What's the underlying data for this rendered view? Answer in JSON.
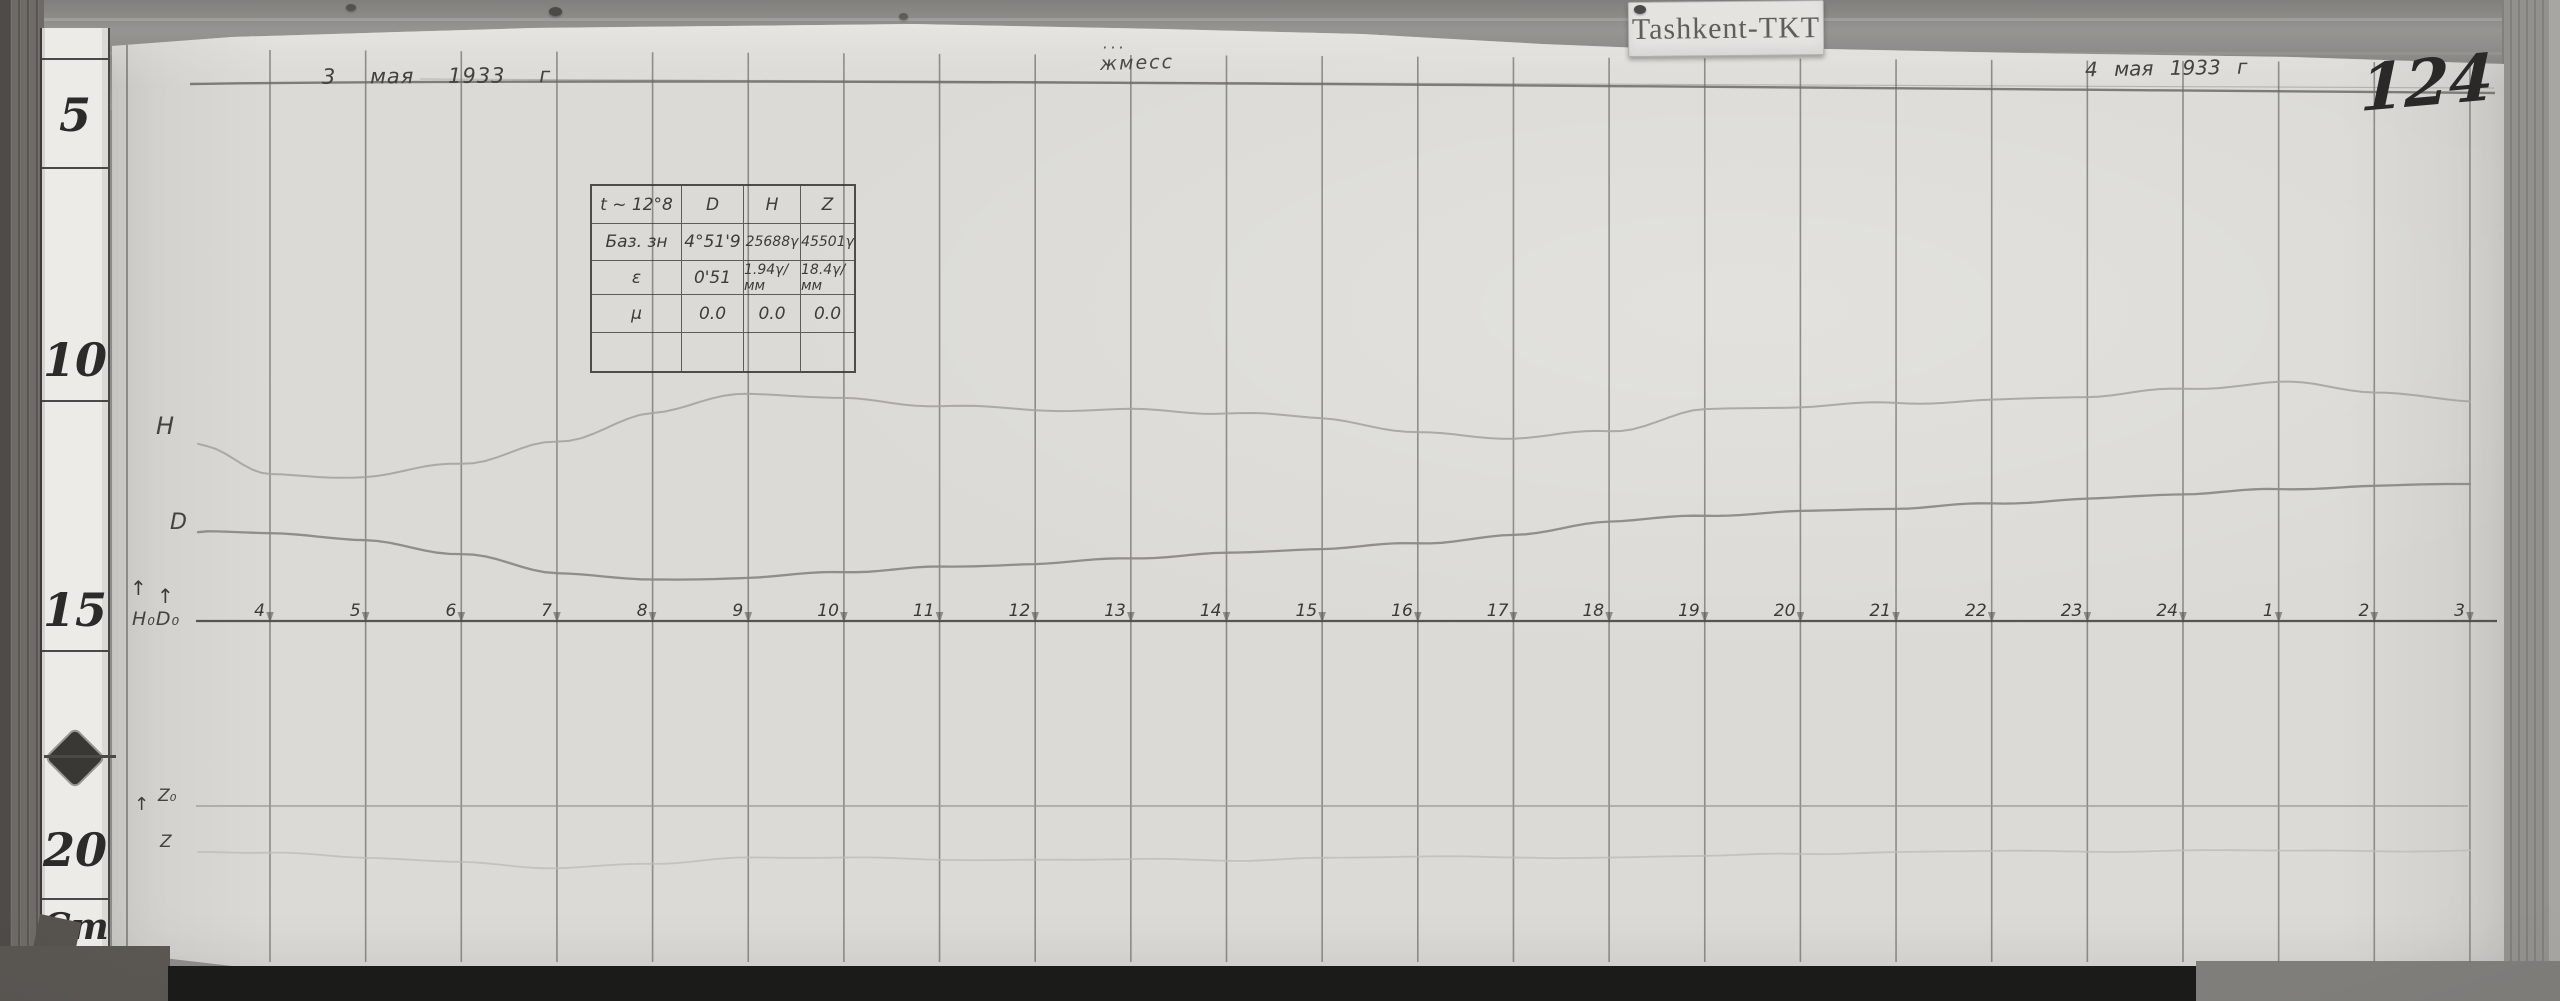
{
  "scene": {
    "station_label": "Tashkent-TKT",
    "page_number": "124",
    "date_left": "3 мая 1933 г",
    "date_right": "4 мая 1933 г",
    "center_annotation": "жмесс",
    "center_annotation_dots": "···",
    "up_arrow": "↑"
  },
  "ruler": {
    "marks": [
      "5",
      "10",
      "15",
      "20"
    ],
    "unit": "Cm"
  },
  "trace_labels": {
    "h": "H",
    "d": "D",
    "baseline": "H₀D₀",
    "z0": "Z₀",
    "z": "Z"
  },
  "table": {
    "header": [
      "t ~ 12°8",
      "D",
      "H",
      "Z"
    ],
    "rows": [
      [
        "Баз. зн",
        "4°51'9",
        "25688γ",
        "45501γ"
      ],
      [
        "ε",
        "0'51",
        "1.94γ/мм",
        "18.4γ/мм"
      ],
      [
        "μ",
        "0.0",
        "0.0",
        "0.0"
      ],
      [
        "",
        "",
        "",
        ""
      ]
    ]
  },
  "chart_data": {
    "type": "line",
    "title": "Magnetogram Tashkent-TKT, 3–4 мая 1933 г",
    "xlabel": "hour (local time)",
    "ylabel": "pen deflection, mm from baseline",
    "categories": [
      "4",
      "5",
      "6",
      "7",
      "8",
      "9",
      "10",
      "11",
      "12",
      "13",
      "14",
      "15",
      "16",
      "17",
      "18",
      "19",
      "20",
      "21",
      "22",
      "23",
      "24",
      "1",
      "2",
      "3"
    ],
    "series": [
      {
        "name": "H",
        "baseline": "H₀D₀",
        "unit": "mm above baseline",
        "lead_in_mm": 37.7,
        "values": [
          31.0,
          30.4,
          33.6,
          38.1,
          44.5,
          48.5,
          47.0,
          45.7,
          45.1,
          45.1,
          44.3,
          43.0,
          39.8,
          39.1,
          40.6,
          44.9,
          45.5,
          46.2,
          47.0,
          48.1,
          49.4,
          50.6,
          48.7,
          46.6
        ]
      },
      {
        "name": "D",
        "baseline": "H₀D₀",
        "unit": "mm above baseline",
        "lead_in_mm": 18.9,
        "values": [
          18.7,
          17.0,
          14.3,
          10.4,
          8.7,
          9.1,
          10.4,
          11.5,
          12.3,
          13.4,
          14.3,
          15.3,
          16.6,
          18.3,
          21.3,
          22.3,
          23.2,
          24.0,
          25.1,
          26.0,
          27.0,
          27.9,
          28.7,
          29.4
        ]
      },
      {
        "name": "Z",
        "baseline": "Z₀",
        "unit": "mm relative to baseline",
        "lead_in_mm": -9.8,
        "values": [
          -10.0,
          -10.9,
          -11.9,
          -13.2,
          -12.3,
          -11.1,
          -10.9,
          -11.3,
          -11.5,
          -11.3,
          -11.7,
          -11.1,
          -10.6,
          -10.9,
          -11.1,
          -10.6,
          -10.2,
          -9.8,
          -9.4,
          -9.8,
          -9.6,
          -9.4,
          -9.6,
          -9.4
        ]
      }
    ],
    "layout": {
      "grid": "vertical line at every hour",
      "legend": false,
      "x_range": [
        "4h",
        "3h next day"
      ]
    }
  }
}
